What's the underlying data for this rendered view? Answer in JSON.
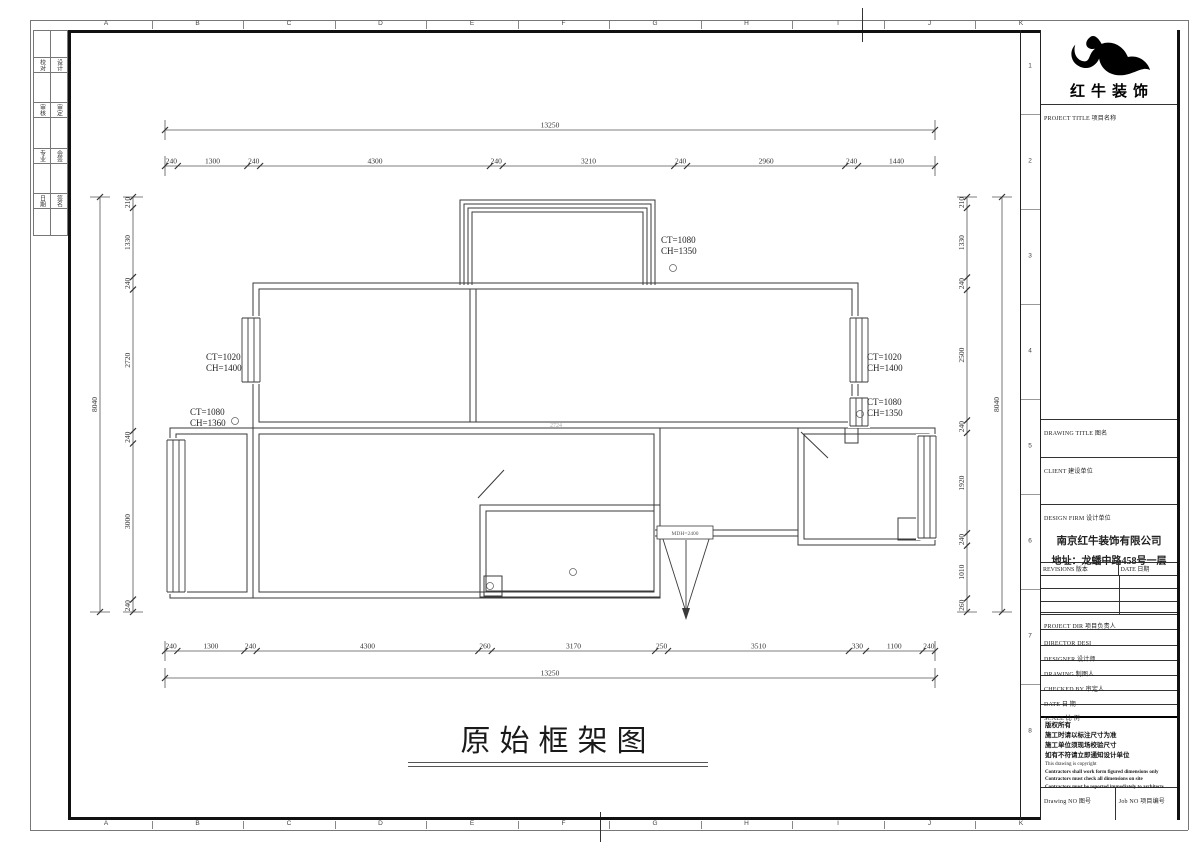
{
  "page": {
    "caption": "原始框架图"
  },
  "frame": {
    "grid_letters": [
      "A",
      "B",
      "C",
      "D",
      "E",
      "F",
      "G",
      "H",
      "I",
      "J",
      "K"
    ],
    "grid_numbers": [
      "1",
      "2",
      "3",
      "4",
      "5",
      "6",
      "7",
      "8"
    ],
    "sign_cells": [
      [
        "校对",
        "设计"
      ],
      [
        "审核",
        "审定"
      ],
      [
        "专业",
        "会签"
      ],
      [
        "日期",
        "签名"
      ]
    ]
  },
  "title_block": {
    "brand": "红牛装饰",
    "labels": {
      "project_title": "PROJECT TITLE  项目名称",
      "drawing_title": "DRAWING TITLE  图名",
      "client": "CLIENT  建设单位",
      "design_firm": "DESIGN FIRM  设计单位",
      "revisions": "REVISIONS  版本",
      "date_col": "DATE  日期",
      "project_dir": "PROJECT DIR   项目负责人",
      "director": "DIRECTOR DESI",
      "designer": "DESIGNER      设计师",
      "drawing": "DRAWING       制图人",
      "checked_by": "CHECKED BY    审定人",
      "date": "DATE          日  期",
      "scale": "SCALE         比  例",
      "drawing_no": "Drawing NO  图号",
      "job_no": "Job NO  项目编号"
    },
    "firm_name": "南京红牛装饰有限公司",
    "firm_address": "地址：龙蟠中路458号一层",
    "notice_zh": [
      "版权所有",
      "施工时请以标注尺寸为准",
      "施工单位须现场校验尺寸",
      "如有不符请立即通知设计单位"
    ],
    "notice_en": [
      "This drawing is copyright",
      "Contractors shall work form figured dimensions only",
      "Contractors must check all dimensions on site",
      "Contractors must be reported immediately to architects"
    ]
  },
  "plan": {
    "dim_rows": [
      {
        "id": "top-overall",
        "orient": "h",
        "x0": 165,
        "x1": 935,
        "y": 130,
        "values": [
          13250
        ]
      },
      {
        "id": "top-segments",
        "orient": "h",
        "x0": 165,
        "x1": 935,
        "y": 166,
        "values": [
          240,
          1300,
          240,
          4300,
          240,
          3210,
          240,
          2960,
          240,
          1440
        ]
      },
      {
        "id": "bottom-segments",
        "orient": "h",
        "x0": 165,
        "x1": 935,
        "y": 651,
        "values": [
          240,
          1300,
          240,
          4300,
          260,
          3170,
          250,
          3510,
          330,
          1100,
          240
        ]
      },
      {
        "id": "bottom-overall",
        "orient": "h",
        "x0": 165,
        "x1": 935,
        "y": 678,
        "values": [
          13250
        ]
      },
      {
        "id": "left-segments",
        "orient": "v",
        "x": 133,
        "y0": 197,
        "y1": 612,
        "values": [
          210,
          1330,
          240,
          2720,
          240,
          3000,
          240
        ]
      },
      {
        "id": "left-overall",
        "orient": "v",
        "x": 100,
        "y0": 197,
        "y1": 612,
        "values": [
          8040
        ]
      },
      {
        "id": "right-segments",
        "orient": "v",
        "x": 967,
        "y0": 197,
        "y1": 612,
        "values": [
          210,
          1330,
          240,
          2500,
          240,
          1920,
          240,
          1010,
          260
        ]
      },
      {
        "id": "right-overall",
        "orient": "v",
        "x": 1002,
        "y0": 197,
        "y1": 612,
        "values": [
          8040
        ]
      }
    ],
    "annotations": [
      {
        "l1": "CT=1080",
        "l2": "CH=1350",
        "x": 661,
        "y": 243
      },
      {
        "l1": "CT=1020",
        "l2": "CH=1400",
        "x": 206,
        "y": 360
      },
      {
        "l1": "CT=1080",
        "l2": "CH=1360",
        "x": 190,
        "y": 415
      },
      {
        "l1": "CT=1020",
        "l2": "CH=1400",
        "x": 867,
        "y": 360
      },
      {
        "l1": "CT=1080",
        "l2": "CH=1350",
        "x": 867,
        "y": 405
      }
    ],
    "circles": [
      {
        "x": 673,
        "y": 268
      },
      {
        "x": 235,
        "y": 421
      },
      {
        "x": 860,
        "y": 414
      },
      {
        "x": 490,
        "y": 586
      },
      {
        "x": 573,
        "y": 572
      }
    ],
    "door_label": "MDH=2400",
    "center_label": "2724"
  }
}
